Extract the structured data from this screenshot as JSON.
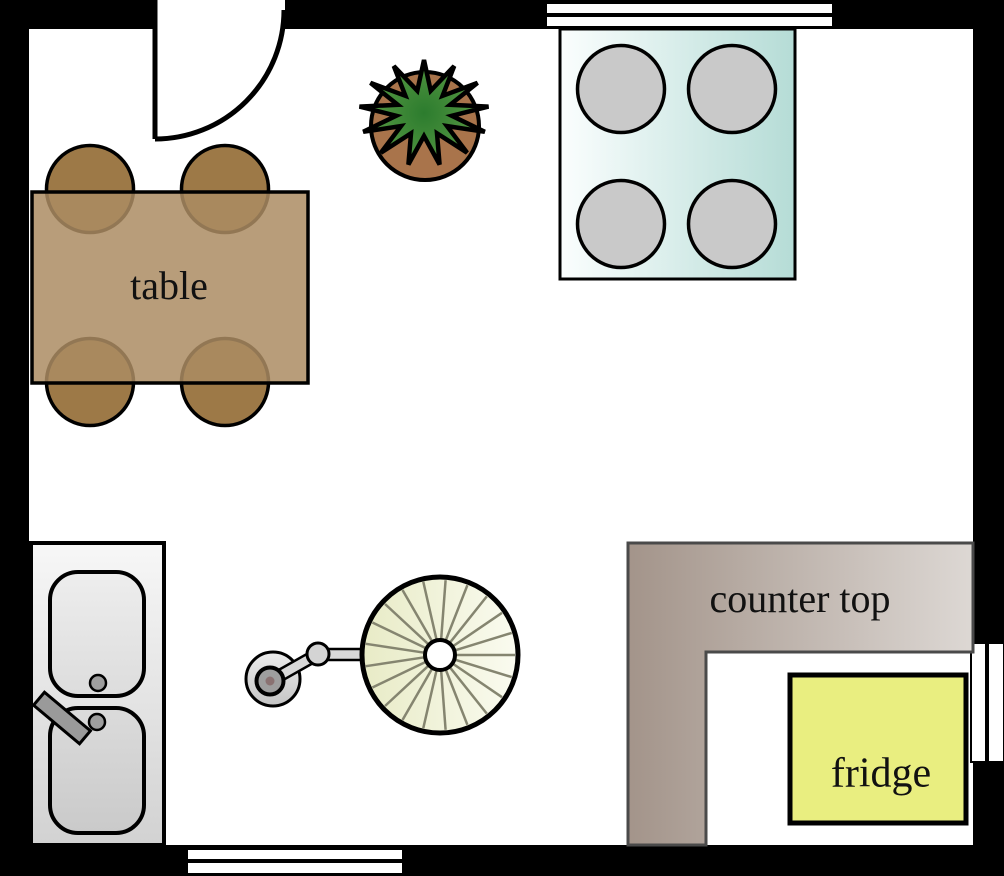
{
  "diagram": {
    "type": "kitchen floor plan",
    "labels": {
      "table": "table",
      "counter_top": "counter top",
      "fridge": "fridge"
    },
    "colors": {
      "wall": "#000000",
      "room": "#ffffff",
      "table_fill": "#ac8c63",
      "chair_fill": "#9d7947",
      "stove_teal": "#b5dcd6",
      "burner_gray": "#c9c9c9",
      "plant_foliage_dark": "#2c7c2e",
      "plant_foliage_light": "#5a9a44",
      "plant_pot": "#a9744b",
      "sink_gray": "#e0e0e0",
      "counter_taupe": "#a3948a",
      "fridge_yellow": "#e9ee80",
      "fan_disc": "#e9ecc9",
      "outline": "#000000",
      "counter_outline": "#4a4a4a"
    },
    "items": [
      "door",
      "window-top",
      "window-bottom",
      "window-right",
      "stove",
      "plant",
      "table",
      "chairs",
      "sink",
      "faucet",
      "fan",
      "counter-top",
      "fridge"
    ]
  }
}
